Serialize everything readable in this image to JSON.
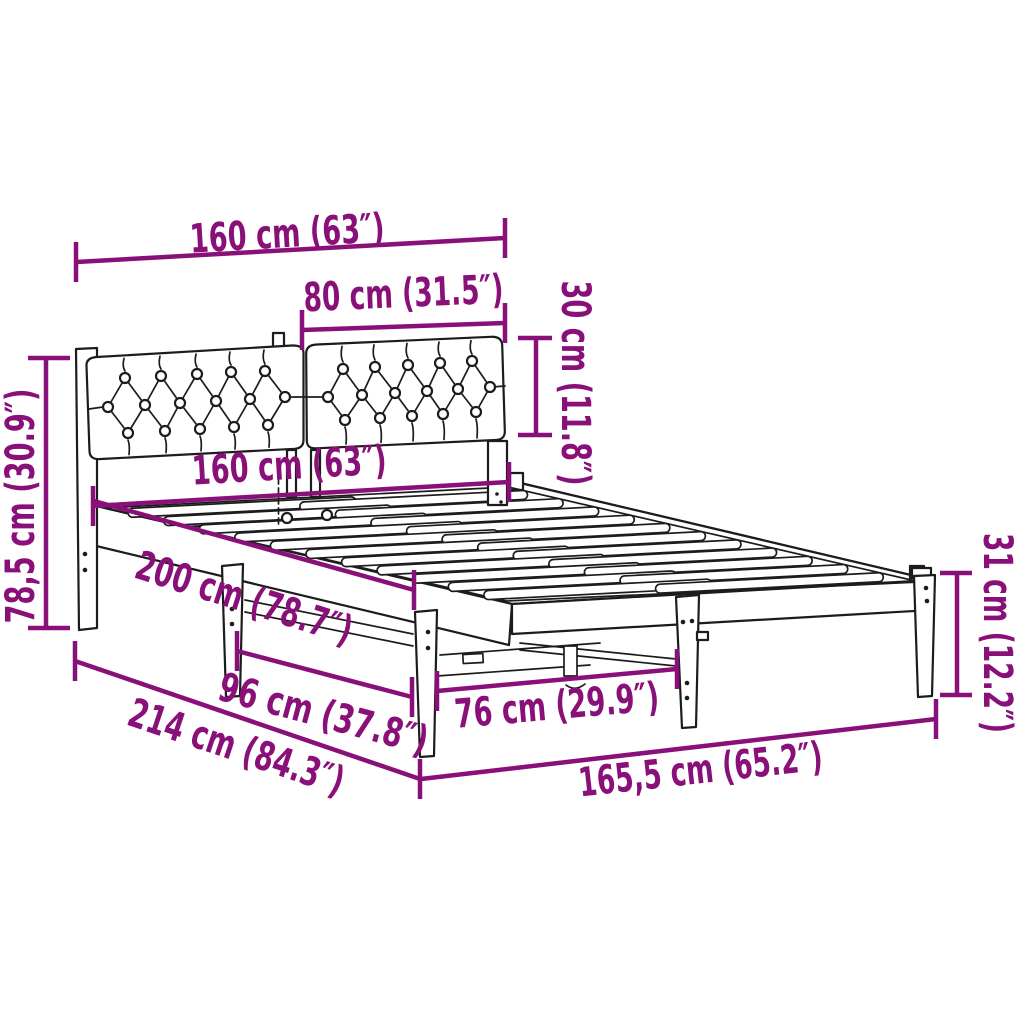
{
  "diagram": {
    "kind": "product-dimension-diagram",
    "subject": "bed frame with tufted headboard and slatted base",
    "colors": {
      "dimension": "#8a1079",
      "line_art": "#1c1c1c",
      "background": "#ffffff"
    },
    "dimensions": {
      "headboard_width": "160 cm (63″)",
      "cushion_width": "80 cm (31.5″)",
      "cushion_height": "30 cm (11.8″)",
      "bed_width": "160 cm (63″)",
      "headboard_height": "78,5 cm (30.9″)",
      "mattress_length": "200 cm (78.7″)",
      "leg_spacing_side": "96 cm (37.8″)",
      "total_length": "214 cm (84.3″)",
      "leg_spacing_foot": "76 cm (29.9″)",
      "frame_length": "165,5 cm (65.2″)",
      "frame_height": "31 cm (12.2″)"
    }
  }
}
